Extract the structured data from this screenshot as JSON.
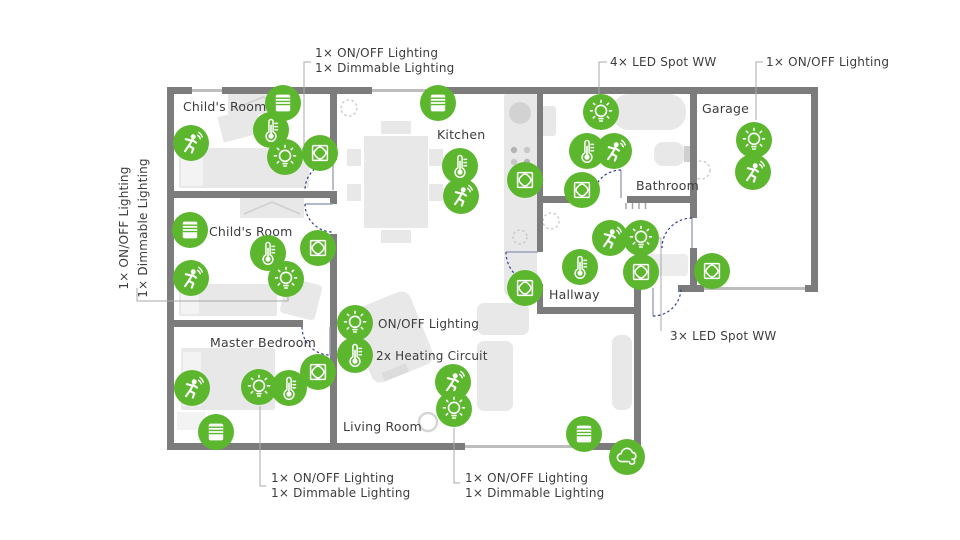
{
  "page": {
    "background": "#ffffff"
  },
  "colors": {
    "accent_green": "#5cb72f",
    "wall_gray": "#7c7c7c",
    "furniture_gray": "#e8e8e8",
    "text_gray": "#3d3d3d",
    "door_blue": "#30408f"
  },
  "rooms": [
    {
      "name": "Child's Room"
    },
    {
      "name": "Child's Room"
    },
    {
      "name": "Master Bedroom"
    },
    {
      "name": "Kitchen"
    },
    {
      "name": "Living Room"
    },
    {
      "name": "Bathroom"
    },
    {
      "name": "Hallway"
    },
    {
      "name": "Garage"
    }
  ],
  "annotations": {
    "top_left": {
      "line1": "1× ON/OFF Lighting",
      "line2": "1× Dimmable Lighting"
    },
    "top_center": {
      "text": "4× LED Spot WW"
    },
    "top_right": {
      "text": "1× ON/OFF Lighting"
    },
    "left_side": {
      "line1": "1× ON/OFF Lighting",
      "line2": "1× Dimmable Lighting"
    },
    "living_legend": {
      "onoff": "ON/OFF Lighting",
      "heating": "2x Heating Circuit"
    },
    "hallway_spots": {
      "text": "3× LED Spot WW"
    },
    "bottom_left": {
      "line1": "1× ON/OFF Lighting",
      "line2": "1× Dimmable Lighting"
    },
    "bottom_center": {
      "line1": "1× ON/OFF Lighting",
      "line2": "1× Dimmable Lighting"
    }
  },
  "icons": {
    "bulb": "lightbulb-icon",
    "thermo": "thermometer-icon",
    "motion": "motion-sensor-icon",
    "blinds": "blinds-icon",
    "switch": "touch-switch-icon",
    "weather": "weather-station-icon"
  },
  "devices": [
    {
      "room": "Child's Room 1",
      "type": "blinds",
      "x": 283,
      "y": 103
    },
    {
      "room": "Child's Room 1",
      "type": "motion",
      "x": 191,
      "y": 143
    },
    {
      "room": "Child's Room 1",
      "type": "thermo",
      "x": 271,
      "y": 130
    },
    {
      "room": "Child's Room 1",
      "type": "bulb",
      "x": 285,
      "y": 157
    },
    {
      "room": "Child's Room 1",
      "type": "switch",
      "x": 320,
      "y": 153
    },
    {
      "room": "Child's Room 2",
      "type": "blinds",
      "x": 190,
      "y": 230
    },
    {
      "room": "Child's Room 2",
      "type": "thermo",
      "x": 268,
      "y": 253
    },
    {
      "room": "Child's Room 2",
      "type": "motion",
      "x": 191,
      "y": 278
    },
    {
      "room": "Child's Room 2",
      "type": "bulb",
      "x": 286,
      "y": 279
    },
    {
      "room": "Child's Room 2",
      "type": "switch",
      "x": 318,
      "y": 248
    },
    {
      "room": "Master Bedroom",
      "type": "motion",
      "x": 192,
      "y": 388
    },
    {
      "room": "Master Bedroom",
      "type": "bulb",
      "x": 259,
      "y": 387
    },
    {
      "room": "Master Bedroom",
      "type": "thermo",
      "x": 289,
      "y": 388
    },
    {
      "room": "Master Bedroom",
      "type": "switch",
      "x": 318,
      "y": 372
    },
    {
      "room": "Master Bedroom",
      "type": "blinds",
      "x": 216,
      "y": 432
    },
    {
      "room": "Kitchen",
      "type": "blinds",
      "x": 438,
      "y": 103
    },
    {
      "room": "Kitchen",
      "type": "thermo",
      "x": 460,
      "y": 166
    },
    {
      "room": "Kitchen",
      "type": "motion",
      "x": 461,
      "y": 196
    },
    {
      "room": "Kitchen",
      "type": "switch",
      "x": 525,
      "y": 180
    },
    {
      "room": "Living Room",
      "type": "bulb",
      "x": 355,
      "y": 323
    },
    {
      "room": "Living Room",
      "type": "thermo",
      "x": 355,
      "y": 355
    },
    {
      "room": "Living Room",
      "type": "motion",
      "x": 453,
      "y": 382
    },
    {
      "room": "Living Room",
      "type": "bulb",
      "x": 454,
      "y": 409
    },
    {
      "room": "Living Room",
      "type": "blinds",
      "x": 584,
      "y": 434
    },
    {
      "room": "Living Room",
      "type": "weather",
      "x": 627,
      "y": 457
    },
    {
      "room": "Bathroom",
      "type": "bulb",
      "x": 601,
      "y": 112
    },
    {
      "room": "Bathroom",
      "type": "thermo",
      "x": 587,
      "y": 151
    },
    {
      "room": "Bathroom",
      "type": "motion",
      "x": 614,
      "y": 151
    },
    {
      "room": "Bathroom",
      "type": "switch",
      "x": 582,
      "y": 190
    },
    {
      "room": "Hallway",
      "type": "motion",
      "x": 610,
      "y": 238
    },
    {
      "room": "Hallway",
      "type": "bulb",
      "x": 641,
      "y": 238
    },
    {
      "room": "Hallway",
      "type": "thermo",
      "x": 580,
      "y": 267
    },
    {
      "room": "Hallway",
      "type": "switch",
      "x": 641,
      "y": 272
    },
    {
      "room": "Hallway",
      "type": "switch",
      "x": 525,
      "y": 288
    },
    {
      "room": "Hallway",
      "type": "switch",
      "x": 712,
      "y": 271
    },
    {
      "room": "Garage",
      "type": "bulb",
      "x": 754,
      "y": 140
    },
    {
      "room": "Garage",
      "type": "motion",
      "x": 753,
      "y": 172
    }
  ]
}
